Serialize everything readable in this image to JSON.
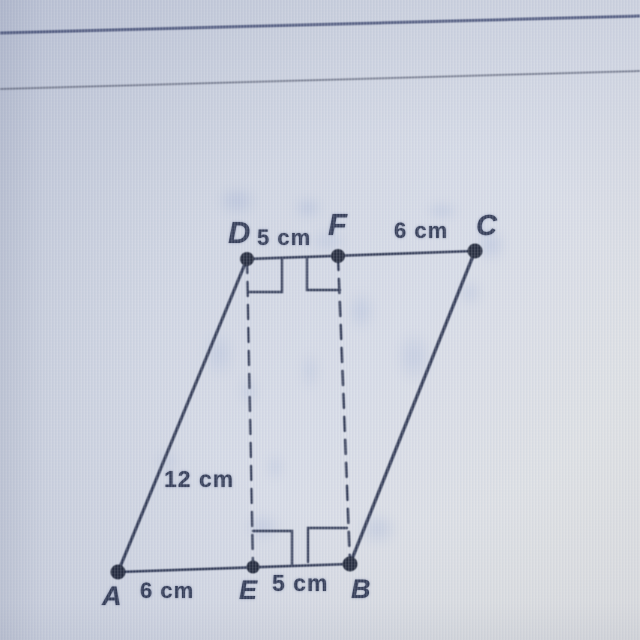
{
  "diagram": {
    "vertex_labels": {
      "A": "A",
      "B": "B",
      "C": "C",
      "D": "D",
      "E": "E",
      "F": "F"
    },
    "measurements": {
      "df": "5 cm",
      "fc": "6 cm",
      "ad": "12 cm",
      "ae": "6 cm",
      "eb": "5 cm"
    },
    "colors": {
      "ink": "#2b3450",
      "dot": "#1c2336",
      "top_rule": "#4a5479",
      "second_rule": "#71778a",
      "screen_tint_dark": "#c2c9db",
      "screen_tint_light": "#dedfe1",
      "speckle": "#7a91c8"
    }
  }
}
